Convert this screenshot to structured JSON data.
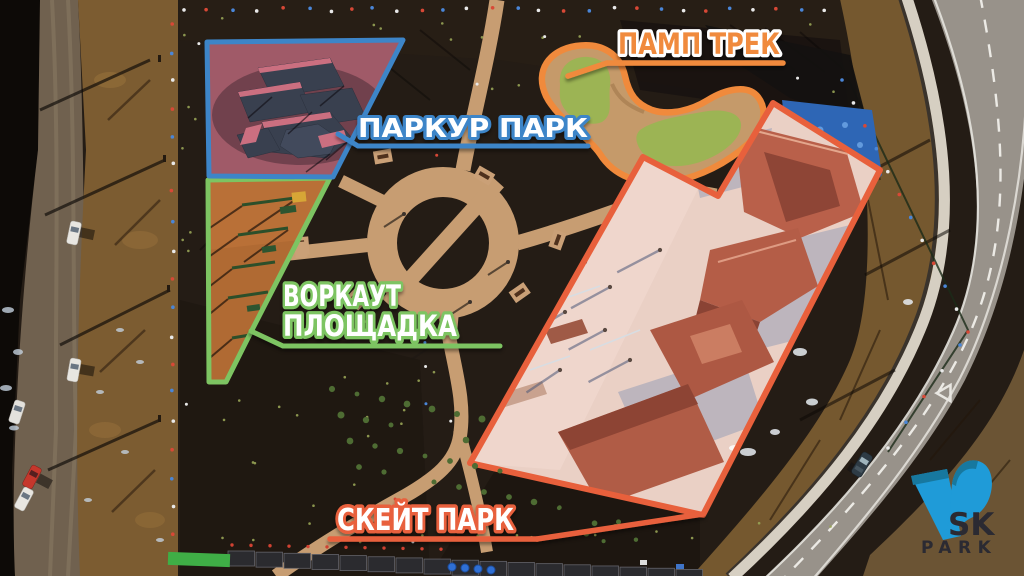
{
  "annotations": {
    "pump_track": {
      "label": "ПАМП ТРЕК",
      "color": "#f08a3c"
    },
    "parkour_park": {
      "label": "ПАРКУР ПАРК",
      "color": "#3d85c8"
    },
    "workout_area": {
      "label_line1": "ВОРКАУТ",
      "label_line2": "ПЛОЩАДКА",
      "color": "#7dc462"
    },
    "skate_park": {
      "label": "СКЕЙТ ПАРК",
      "color": "#e8603c"
    }
  },
  "logo": {
    "sk": "SK",
    "park": "PARK",
    "icon": "v-glyph",
    "icon_color": "#1f9bd8",
    "text_color": "#2b2a32"
  },
  "scene": {
    "ground_color": "#241c15",
    "path_color": "#c79d72",
    "skate_surface_color": "#ead0c5",
    "workout_surface_color": "#b06a33",
    "parkour_surface_color": "#a05a68",
    "pump_grass_color": "#9cb454"
  }
}
